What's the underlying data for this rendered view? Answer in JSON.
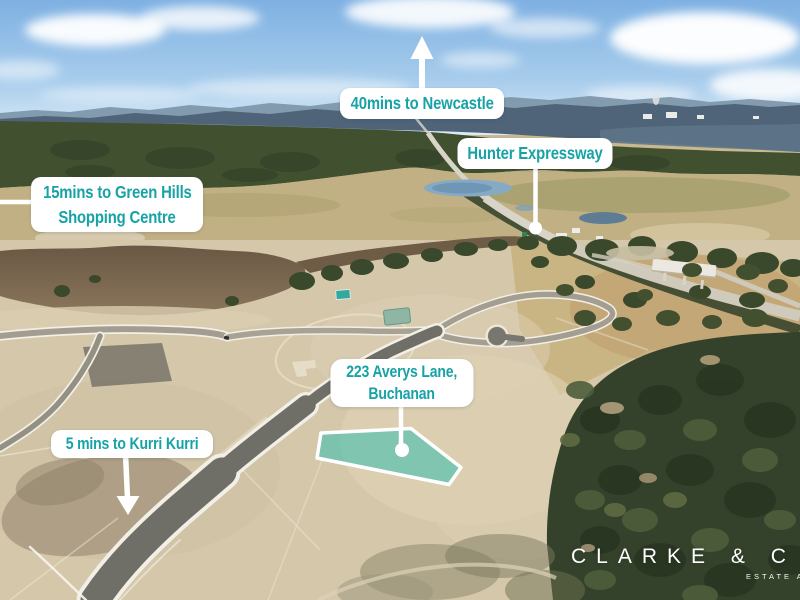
{
  "callouts": {
    "newcastle": {
      "text": "40mins to Newcastle"
    },
    "hunter_expressway": {
      "text": "Hunter Expressway"
    },
    "green_hills": {
      "line1": "15mins to Green Hills",
      "line2": "Shopping Centre"
    },
    "property": {
      "line1": "223 Averys Lane,",
      "line2": "Buchanan"
    },
    "kurri_kurri": {
      "text": "5 mins to Kurri Kurri"
    }
  },
  "branding": {
    "agency": "CLARKE & C",
    "tagline": "ESTATE A"
  },
  "colors": {
    "callout_text": "#17a3a6",
    "callout_bg": "#ffffff",
    "pointer": "#ffffff",
    "lot_highlight": "#3dbfb0"
  }
}
